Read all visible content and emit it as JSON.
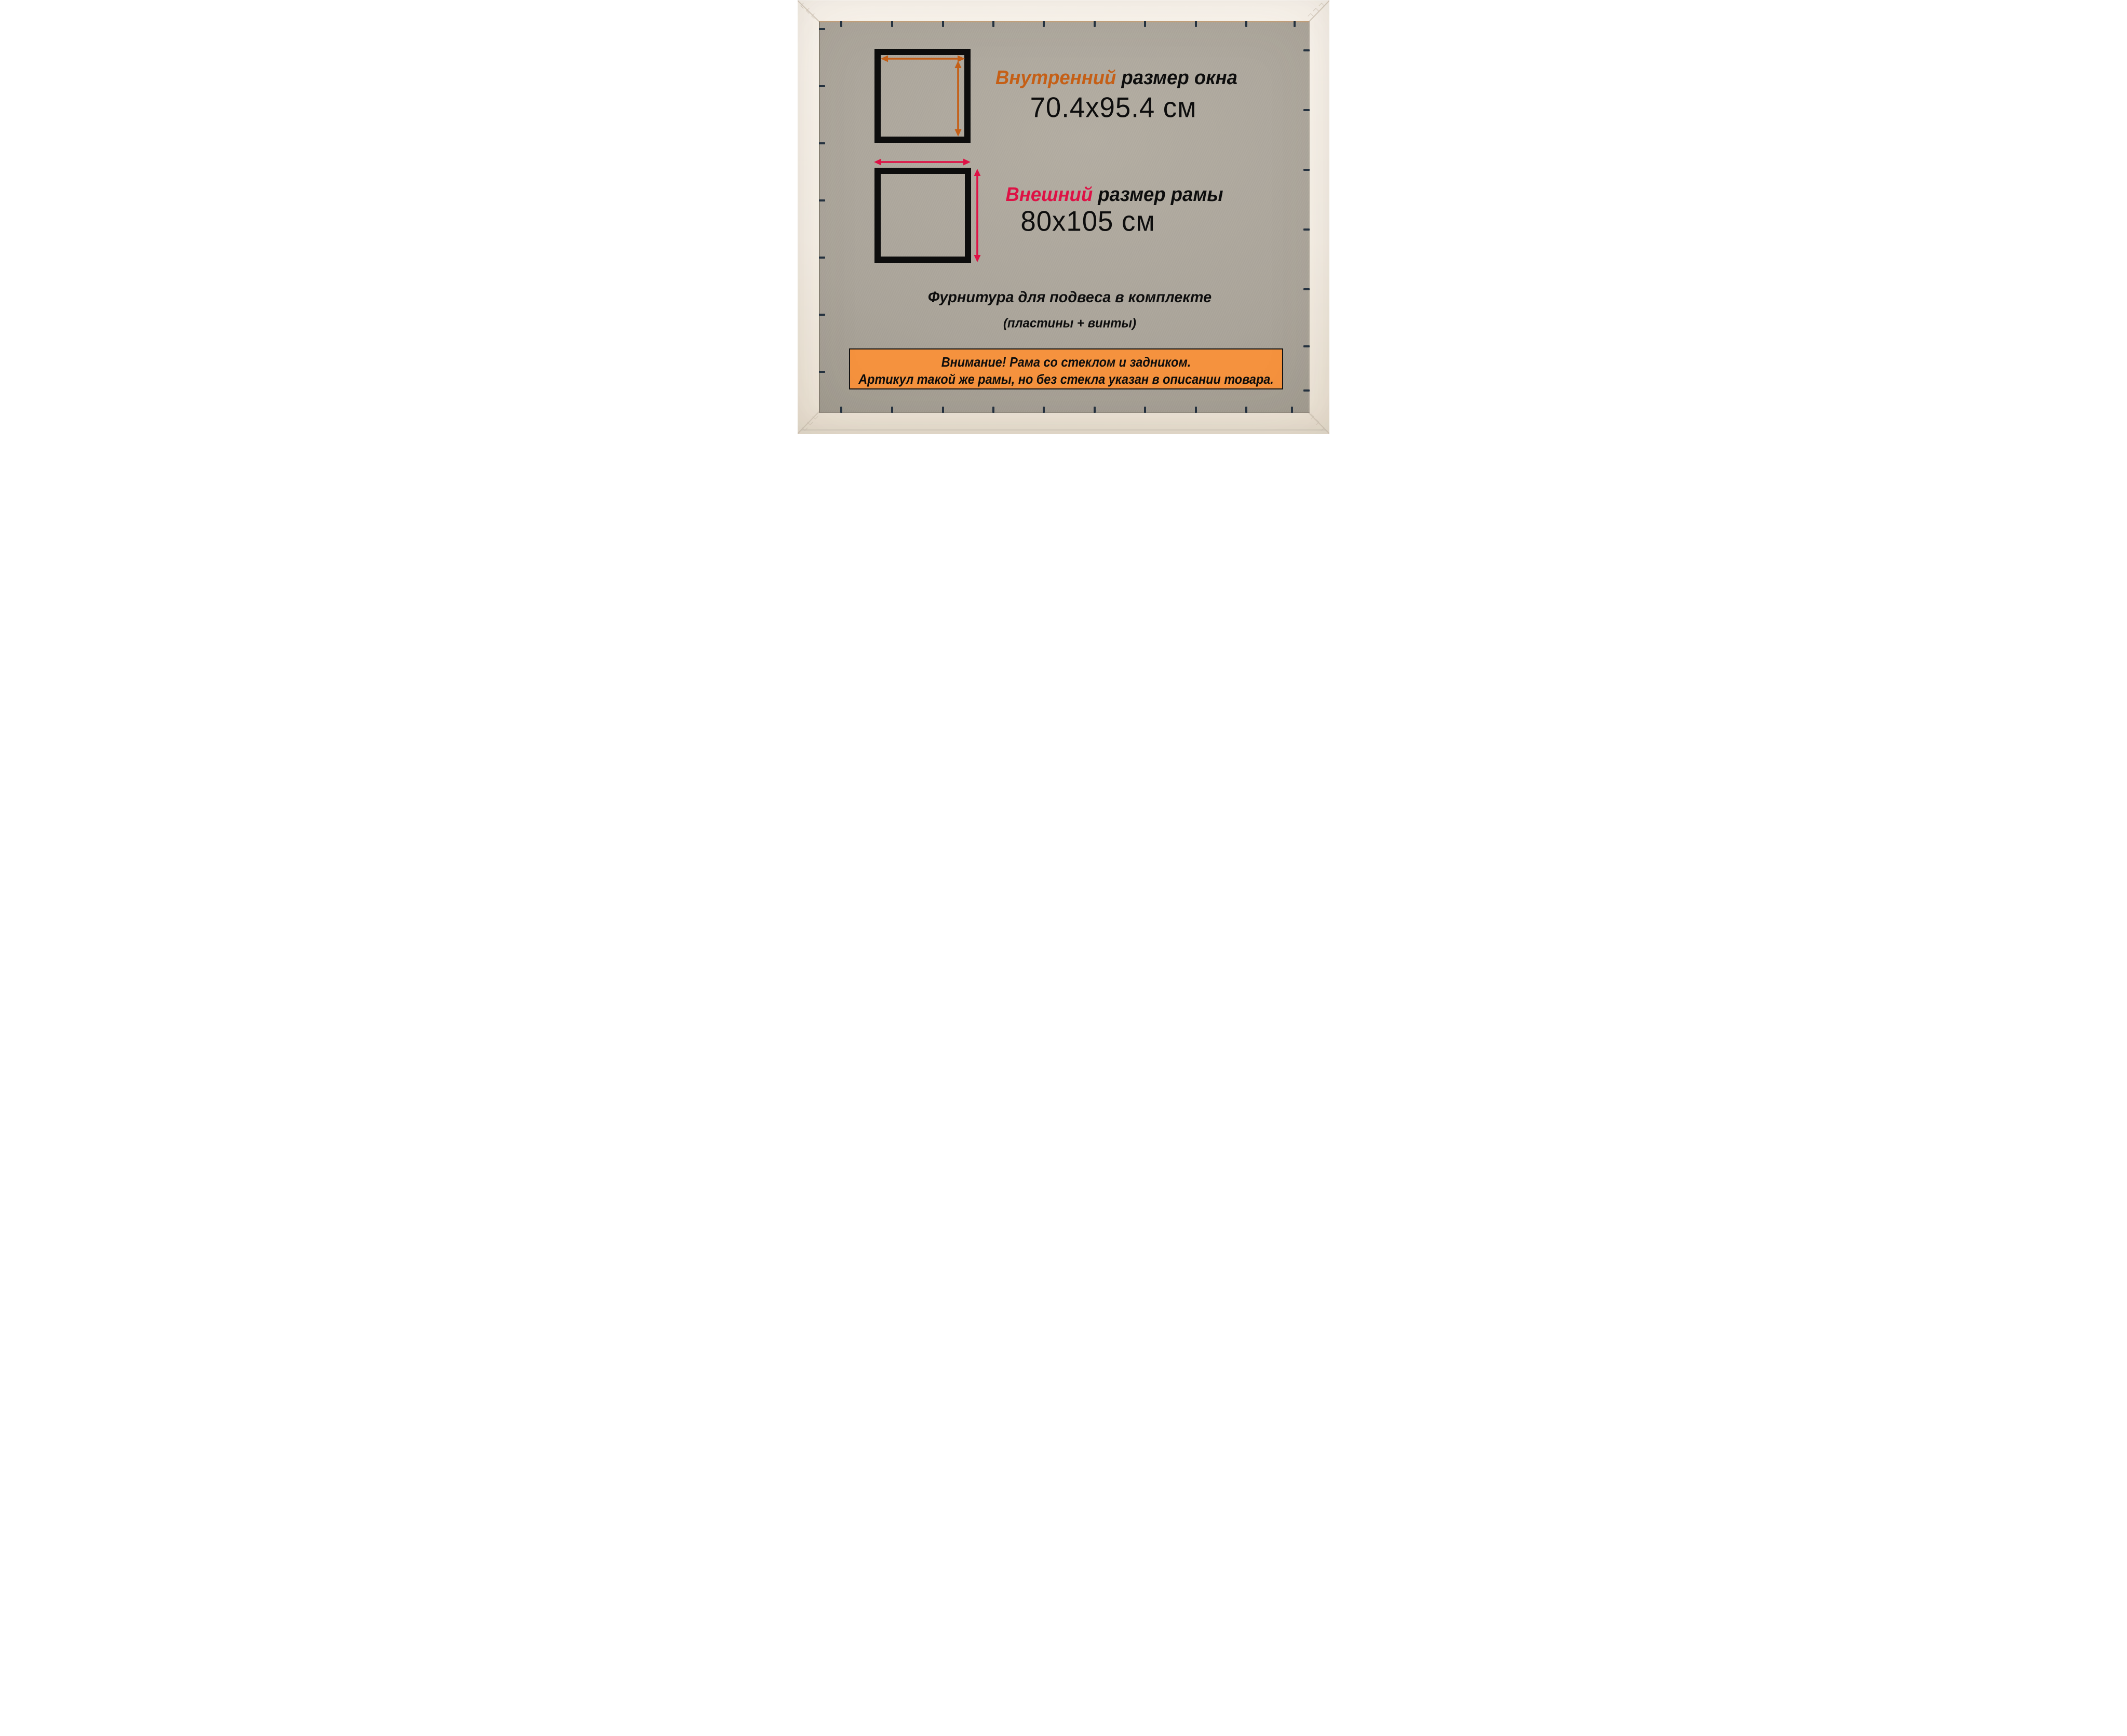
{
  "palette": {
    "frame_light": "#faf5ee",
    "frame_mid": "#f6f0e7",
    "frame_dark": "#ece3d5",
    "backing_light": "#b4aea3",
    "backing_mid": "#aba59a",
    "backing_dark": "#9a9488",
    "rabbet": "#c4a17c",
    "edge_dark": "#867f73",
    "seam": "#d5cbbc",
    "ink": "#0d0d0d",
    "inner_accent": "#c55f16",
    "outer_accent": "#de1145",
    "banner_bg": "#f5923e",
    "banner_border": "#141414",
    "staple": "#243240"
  },
  "inner_size": {
    "label_accent": "Внутренний",
    "label_rest": " размер окна",
    "value": "70.4x95.4 см"
  },
  "outer_size": {
    "label_accent": "Внешний",
    "label_rest": " размер рамы",
    "value": "80x105 см"
  },
  "hardware": {
    "line1": "Фурнитура для подвеса в комплекте",
    "line2": "(пластины + винты)"
  },
  "banner": {
    "line1": "Внимание! Рама со стеклом и задником.",
    "line2": "Артикул такой же рамы, но без стекла указан в описании товара."
  },
  "icons": {
    "inner_width_arrow": "double-arrow-horizontal",
    "inner_height_arrow": "double-arrow-vertical",
    "outer_width_arrow": "double-arrow-horizontal",
    "outer_height_arrow": "double-arrow-vertical",
    "staple_mark": "backing-clip-tick",
    "corner_seam": "miter-joint-line"
  }
}
